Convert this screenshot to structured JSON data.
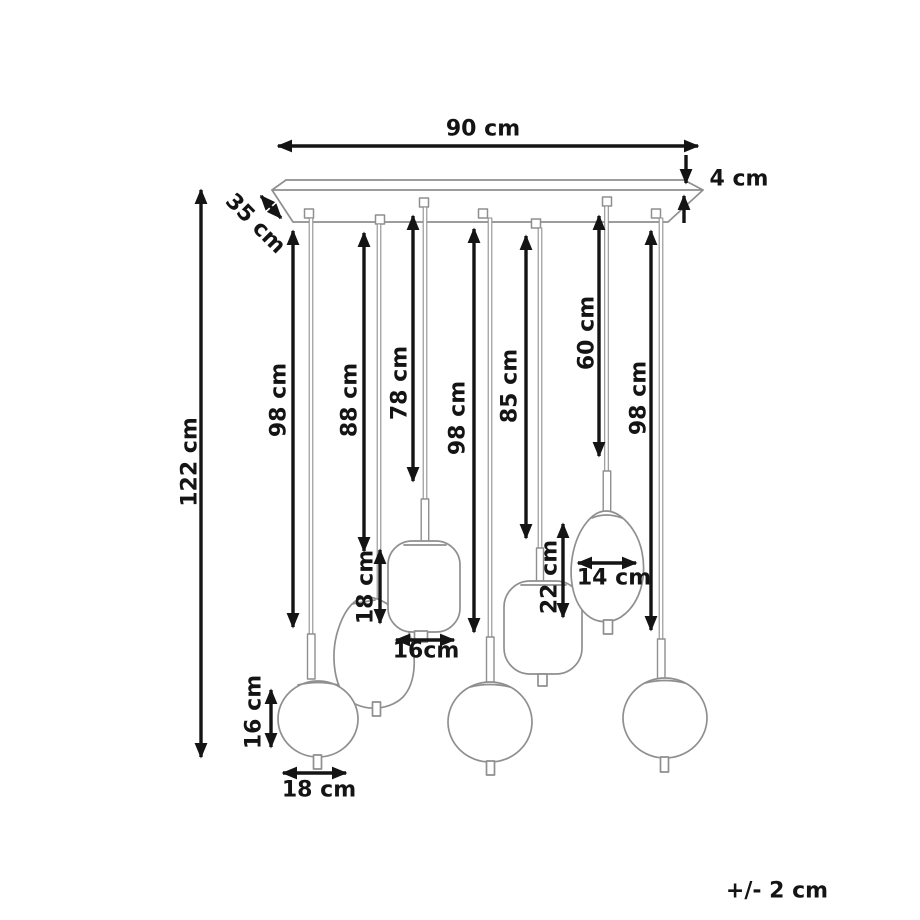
{
  "diagram": {
    "kind": "pendant-lamp-dimension-drawing",
    "tolerance_note": "+/- 2 cm"
  },
  "labels": {
    "canopy_width": "90 cm",
    "canopy_thickness": "4 cm",
    "canopy_depth": "35 cm",
    "overall_height": "122 cm",
    "cord_98_left": "98 cm",
    "cord_88": "88 cm",
    "cord_78": "78 cm",
    "cord_98_center": "98 cm",
    "cord_85": "85 cm",
    "cord_60": "60 cm",
    "cord_98_right": "98 cm",
    "oval_shade_height": "22 cm",
    "oval_shade_width": "14 cm",
    "cube_shade_height": "18 cm",
    "cube_shade_width": "16cm",
    "round_shade_height": "16 cm",
    "round_shade_width": "18 cm",
    "tolerance": "+/- 2 cm"
  },
  "colors": {
    "lamp_outline": "#8f8f8f",
    "dimension": "#141414",
    "background": "#ffffff"
  }
}
